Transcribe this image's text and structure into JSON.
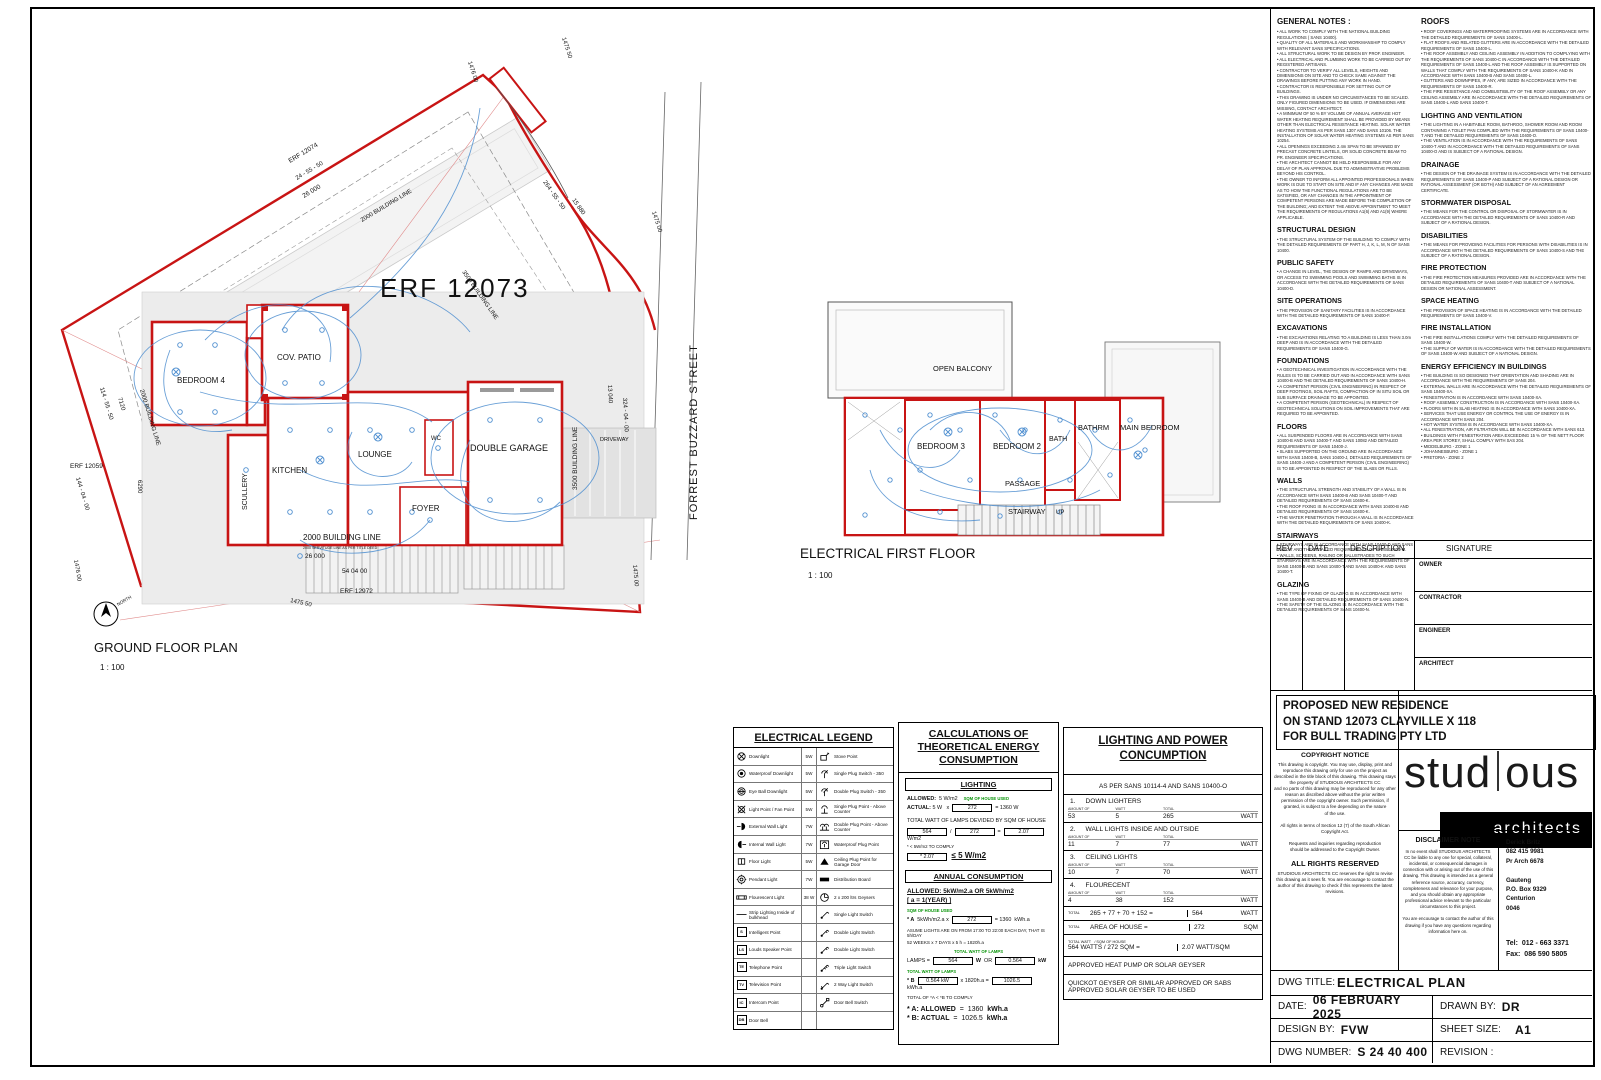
{
  "ground": {
    "plan_title": "GROUND FLOOR PLAN",
    "scale": "1 : 100",
    "erf": "ERF 12073",
    "north": "NORTH",
    "rooms": {
      "bedroom4": "BEDROOM 4",
      "patio": "COV. PATIO",
      "kitchen": "KITCHEN",
      "scullery": "SCULLERY",
      "lounge": "LOUNGE",
      "wc": "WC",
      "foyer": "FOYER",
      "garage": "DOUBLE GARAGE",
      "driveway": "DRIVEWAY"
    },
    "labels": {
      "erf12074": "ERF 12074",
      "erf12059": "ERF 12059",
      "erf12972": "ERF 12972",
      "street": "FORREST BUZZARD STREET",
      "bl2000_top": "2000 BUILDING LINE",
      "bl3500_top": "3500 BUILDING LINE",
      "bl2000_left": "2000 BUILDING LINE",
      "bl2000_bottom": "2000 BUILDING LINE",
      "bl3500_right": "3500 BUILDING LINE",
      "servitude": "2000 SERVITUDE LINE AS PER TITLE DEED",
      "d_1476_top": "1476 00",
      "d_1475_50_top": "1475 50",
      "d_24_55_50": "24 - 55 - 50",
      "d_26000_top": "26 000",
      "d_264_55_50": "264 - 55 - 50",
      "d_15880": "15 880",
      "d_1475_00_right": "1475 00",
      "d_114_55_50": "114 - 55 - 50",
      "d_7120": "7120",
      "d_6290": "6290",
      "d_144_04_00": "144 - 04 - 00",
      "d_13040": "13 040",
      "d_324_04_00": "324 - 04 - 00",
      "d_26000_bottom": "26 000",
      "d_54_04_00": "54 04 00",
      "d_1475_50_bottom": "1475 50",
      "d_1476_bottom": "1476 00",
      "d_1475_00_bottom": "1475 00"
    }
  },
  "first": {
    "plan_title": "ELECTRICAL FIRST FLOOR",
    "scale": "1 : 100",
    "rooms": {
      "balcony": "OPEN BALCONY",
      "bedroom3": "BEDROOM 3",
      "bedroom2": "BEDROOM 2",
      "bath": "BATH",
      "bathrm": "BATHRM",
      "main_bedroom": "MAIN BEDROOM",
      "passage": "PASSAGE",
      "stairway": "STAIRWAY",
      "up": "UP"
    }
  },
  "notes_col1": [
    {
      "heading": "GENERAL NOTES :",
      "body": "• ALL WORK TO COMPLY WITH THE NATIONAL BUILDING REGULATIONS ( SANS 10400).\n• QUALITY OF ALL MATERIALS AND WORKMANSHIP TO COMPLY WITH RELEVANT SANS SPECIFICATIONS.\n• ALL STRUCTURAL WORK TO BE DESIGN BY PROF. ENGINEER.\n• ALL ELECTRICAL AND PLUMBING WORK TO BE CARRIED OUT BY REGISTERED ARTISANS.\n• CONTRACTOR TO VERIFY ALL LEVELS, HEIGHTS AND DIMENSIONS ON SITE AND TO CHECK SAME AGAINST THE DRAWINGS BEFORE PUTTING ANY WORK IN HAND.\n• CONTRACTOR IS RESPONSIBLE FOR SETTING OUT OF BUILDINGS.\n• THIS DRAWING IS UNDER NO CIRCUMSTANCES TO BE SCALED.  ONLY FIGURED DIMENSIONS TO BE USED.  IF DIMENSIONS ARE MISSING, CONTACT ARCHITECT.\n• A MINIMUM OF 50 % BY VOLUME OF ANNUAL AVERAGE HOT WATER HEATING REQUIREMENT SHALL BE PROVIDED BY MEANS OTHER THAN ELECTRICAL RESISTANCE HEATING. SOLAR WATER HEATING SYSTEMS AS PER SANS 1307 AND SANS 10106.  THE INSTALLATION OF SOLAR WATER HEATING SYSTEMS AS PER SANS 10254.\n• ALL OPENINGS EXCEEDING 2.4m SPAN TO BE SPANNED BY PRECAST CONCRETE LINTELS, OR SOLID CONCRETE BEAM TO PR. ENGINEER SPECIFICATIONS.\n• THE ARCHITECT CANNOT BE HELD RESPONSIBLE FOR ANY DELAY OF PLAN APPROVAL DUE TO ADMINISTRATIVE PROBLEMS BEYOND HIS CONTROL.\n• THE OWNER TO INFORM ALL APPOINTED PROFESSIONALS WHEN WORK IS DUE TO START ON SITE AND IF ANY CHANGES ARE MADE AS TO HOW THE FUNCTIONAL REGULATIONS ARE TO BE SATISFIED, OR ANY CHANGES IN THE APPOINTMENT OF COMPETENT PERSONS ARE MADE BEFORE THE COMPLETION OF THE BUILDING;  AND EXTENT THE ABOVE APPOINTMENT TO MEET THE REQUIREMENTS OF REGULATIONS A1(6) AND A1(9) WHERE APPLICABLE."
    },
    {
      "heading": "STRUCTURAL DESIGN",
      "body": "• THE STRUCTURAL SYSTEM OF THE BUILDING TO COMPLY WITH THE DETAILED REQUIREMENTS OF PART H, J, K, L, M, N OF SANS 10400."
    },
    {
      "heading": "PUBLIC SAFETY",
      "body": "• A CHANGE IN LEVEL, THE DESIGN OF RAMPS AND DRIVEWAYS, OR ACCESS TO SWIMMING POOLS AND SWIMMING BATHS IS IN ACCORDANCE WITH THE DETAILED REQUIREMENTS OF SANS 10400-D."
    },
    {
      "heading": "SITE OPERATIONS",
      "body": "• THE PROVISION OF SANITARY FACILITIES IS IN ACCORDANCE WITH THE DETAILED REQUIREMENTS OF SANS 10400-F."
    },
    {
      "heading": "EXCAVATIONS",
      "body": "• THE EXCAVATIONS RELATING TO A BUILDING IS LESS THAN 3.0m DEEP AND IS IN ACCORDANCE WITH THE DETAILED REQUIREMENTS OF SANS 10400-G."
    },
    {
      "heading": "FOUNDATIONS",
      "body": "• A GEOTECHNICAL INVESTIGATION IN ACCORDANCE WITH THE RULES IS TO BE CARRIED OUT AND IN ACCORDANCE WITH SANS 10400-B AND THE DETAILED REQUIREMENTS OF SANS 10400-H.\n• A COMPETENT PERSON (CIVIL ENGINEERING) IN RESPECT OF DEEP FOOTINGS, SOIL RAFTS, COMPACTION OF IN SITU SOIL OR SUB SURFACE DRAINAGE TO BE APPOINTED.\n• A COMPETENT PERSON (GEOTECHNICAL) IN RESPECT OF GEOTECHNICAL SOLUTIONS ON SOIL IMPROVEMENTS THAT ARE REQUIRED TO BE APPOINTED."
    },
    {
      "heading": "FLOORS",
      "body": "• ALL SUSPENDED FLOORS ARE IN ACCORDANCE WITH SANS 10400-B AND SANS 10400-T AND SANS 10082 AND DETAILED REQUIREMENTS OF SANS 10400-J.\n• SLABS SUPPORTED ON THE GROUND ARE IN ACCORDANCE WITH SANS 10400-B, SANS 10400-J, DETAILED REQUIREMENTS OF SANS 10400-J AND A COMPETENT PERSON (CIVIL ENGINEERING) IS TO BE APPOINTED IN RESPECT OF THE SLABS OR FILLS."
    },
    {
      "heading": "WALLS",
      "body": "• THE STRUCTURAL STRENGTH AND STABILITY OF A WALL IS IN ACCORDANCE WITH SANS 10400-B AND SANS 10400-T AND DETAILED REQUIREMENTS OF SANS 10400-K.\n• THE ROOF FIXING IS IN ACCORDANCE WITH SANS 10400-B AND DETAILED REQUIREMENTS OF SANS 10400-K.\n• THE WATER PENETRATION THROUGH A WALL IS IN ACCORDANCE WITH THE DETAILED REQUIREMENTS OF SANS 10400-K."
    },
    {
      "heading": "STAIRWAYS",
      "body": "• STAIRWAYS ARE IN ACCORDANCE WITH SANS 10400-D AND SANS 10400-T AND THE DETAILED REQUIREMENTS OF SANS 10400-M.\n• WALLS, SCREENS, RAILING OR BALUSTRADES TO SUCH STAIRWAYS ARE IN ACCORDANCE WITH THE REQUIREMENTS OF SANS 10400-B AND SANS 10400-T AND SANS 10400-K AND SANS 10400-T."
    },
    {
      "heading": "GLAZING",
      "body": "• THE TYPE OF FIXING OF GLAZING IS IN ACCORDANCE WITH SANS 10400-B AND DETAILED REQUIREMENTS OF SANS 10400-N.\n• THE SAFETY OF THE GLAZING IS IN ACCORDANCE WITH THE DETAILED REQUIREMENTS OF SANS 10400-N."
    }
  ],
  "notes_col2": [
    {
      "heading": "ROOFS",
      "body": "• ROOF COVERINGS AND WATERPROOFING SYSTEMS ARE IN ACCORDANCE WITH THE DETAILED REQUIREMENTS OF SANS 10400-L.\n• FLAT ROOFS AND RELATED GUTTERS ARE IN ACCORDANCE WITH THE DETAILED REQUIREMENTS OF SANS 10400-L.\n• THE ROOF ASSEMBLY AND CEILING ASSEMBLY IN ADDITION TO COMPLYING WITH THE REQUIREMENTS OF SANS 10400-C IN ACCORDANCE WITH THE DETAILED REQUIREMENTS OF SANS 10400-L AND THE ROOF ASSEMBLY IS SUPPORTED ON WALLS THAT COMPLY WITH THE REQUIREMENTS OF SANS 10400-K AND IN ACCORDANCE WITH SANS 10400-B AND SANS 10400-L.\n• GUTTERS AND DOWNPIPES, IF ANY, ARE SIZED IN ACCORDANCE WITH THE REQUIREMENTS OF SANS 10400-R.\n• THE FIRE RESISTANCE AND COMBUSTIBILITY OF THE ROOF ASSEMBLY OR ANY CEILING ASSEMBLY ARE IN ACCORDANCE WITH THE DETAILED REQUIREMENTS OF SANS 10400-L AND SANS 10400-T."
    },
    {
      "heading": "LIGHTING AND VENTILATION",
      "body": "• THE LIGHTING IN A HABITABLE ROOM, BATHROO, SHOWER ROOM AND ROOM CONTAINING A TOILET PAN COMPLIED WITH THE REQUIREMENTS OF SANS 10400-T AND THE DETAILED REQUIREMENTS OF SANS 10400-O.\n• THE VENTILATION IS IN ACCORDANCE WITH THE REQUIREMENTS OF SANS 10400-T AND IN ACCORDANCE WITH THE DETAILED REQUIREMENTS OF SANS 10400-O AND IS SUBJECT OF A RATIONAL DESIGN."
    },
    {
      "heading": "DRAINAGE",
      "body": "• THE DESIGN OF THE DRAINAGE SYSTEM IS IN ACCORDANCE WITH THE DETAILED REQUIREMENTS OF SANS 10400-P AND SUBJECT OF A RATIONAL DESIGN OR RATIONAL ASSESSMENT (OR BOTH) AND SUBJECT OF AN AGREEMENT CERTIFICATE."
    },
    {
      "heading": "STORMWATER DISPOSAL",
      "body": "• THE MEANS FOR THE CONTROL OR DISPOSAL OF STORMWATER IS IN ACCORDANCE WITH THE DETAILED REQUIREMENTS OF SANS 10400-R AND SUBJECT OF A RATIONAL DESIGN."
    },
    {
      "heading": "DISABILITIES",
      "body": "• THE MEANS FOR PROVIDING FACILITIES FOR PERSONS WITH DISABILITIES IS IN ACCORDANCE WITH THE DETAILED REQUIREMENTS OF SANS 10400-S AND THE SUBJECT OF A RATIONAL DESIGN."
    },
    {
      "heading": "FIRE PROTECTION",
      "body": "• THE FIRE PROTECTION MEASURES PROVIDED ARE IN ACCORDANCE WITH THE DETAILED REQUIREMENTS OF SANS 10400-T AND SUBJECT OF A NATIONAL DESIGN OR NATIONAL ASSESSMENT."
    },
    {
      "heading": "SPACE HEATING",
      "body": "• THE PROVISION OF SPACE HEATING IS IN ACCORDANCE WITH THE DETAILED REQUIREMENTS OF SANS 10400-V."
    },
    {
      "heading": "FIRE INSTALLATION",
      "body": "• THE FIRE INSTALLATIONS COMPLY WITH THE DETAILED REQUIREMENTS OF SANS 10400-W.\n• THE SUPPLY OF WATER IS IN ACCORDANCE WITH THE DETAILED REQUIREMENTS OF SANS 10400-W AND SUBJECT OF A NATIONAL DESIGN."
    },
    {
      "heading": "ENERGY EFFICIENCY IN  BUILDINGS",
      "body": "• THE BUILDING IS SO DESIGNED THAT ORIENTATION AND SHADING ARE IN ACCORDANCE WITH THE REQUIREMENTS OF SANS 204.\n• EXTERNAL WALLS ARE IN ACCORDANCE WITH THE DETAILED REQUIREMENTS OF SANS 10400-XA.\n• FENESTRATION IS IN ACCORDANCE WITH SANS 10400-XA.\n• ROOF ASSEMBLY CONSTRUCTION IS IN ACCORDANCE WITH SANS 10400-XA.\n• FLOORS WITH IN SLAB HEATING IS IN ACCORDANCE WITH SANS 10400-XA.\n• SERVICES THAT USE ENERGY OR CONTROL THE USE OF ENERGY IS IN ACCORDANCE WITH SANS 204.\n• HOT WATER SYSTEM IS IN ACCORDANCE WITH SANS 10400-XA.\n• ALL FENESTRATION, AIR FILTRATION WILL BE IN ACCORDANCE WITH SANS 613.\n• BUILDINGS WITH FENESTRATION AREA EXCEEDING 15 % OF THE NETT FLOOR AREA PER STOREY, SHALL COMPLY WITH SAS 204.\n• MIDDELBURG - ZONE 1\n• JOHANNESBURG - ZONE 1\n• PRETORIA - ZONE 2"
    }
  ],
  "rev": {
    "rev": "REV",
    "date": "DATE",
    "description": "DESCRIPTION",
    "signature": "SIGNATURE",
    "roles": [
      "OWNER",
      "CONTRACTOR",
      "ENGINEER",
      "ARCHITECT"
    ]
  },
  "project": {
    "line1": "PROPOSED NEW RESIDENCE",
    "line2": "ON STAND 12073 CLAYVILLE X 118",
    "line3": "FOR BULL TRADING PTY LTD"
  },
  "copyright": {
    "title": "COPYRIGHT NOTICE",
    "body": "This drawing is copyright.  You may use, display, print and reproduce this drawing only for use on the project as described in the title block of this drawing.  This drawing stays the property of STUDIOUS ARCHITECTS CC\nand no parts of this drawing may be reproduced for any other reason as discribed above without the prior written permission of the copyright owner.  Such permission, if granted, is subject to a fee depending on the nature\nof the use.",
    "rights": "All rights in terms of Section 12 (7) of the South African Copyright Act.",
    "requests": "Requests and inquiries regarding reproduction\nshould be addressed to the Copyright Owner.",
    "reserved_title": "ALL RIGHTS RESERVED",
    "reserved_body": "STUDIOUS ARCHITECTS CC reserves the right to revise this drawing as it sees fit. You are encourage to contact the author of this drawing to check if this represents the latest revisions."
  },
  "brand": {
    "name_a": "stud",
    "name_b": "ous",
    "sub": "architects"
  },
  "disclaimer": {
    "title": "DISCLAIMER NOTE",
    "body": "In no event shall STUDIOUS ARCHITECTS CC be liable to any one for special, collateral, incidental, or consequencial damages in connection with or arising out of the use of this drawing.  This drawing is intended as a general reference source, accuracy, currency, completeness and relevance for your purpose, and you should obtain any appropriate professional advice relevant to the particular circumstances to this project.",
    "footer": "You are encourage to contact the author of this drawing if you have any questions regarding information here on."
  },
  "contact": {
    "name": "Derick Britz",
    "phone": "082 415 9981",
    "reg": "Pr Arch 6678",
    "province": "Gauteng",
    "pobox": "P.O. Box 9329",
    "city": "Centurion",
    "postal": "0046",
    "tel_label": "Tel:",
    "tel": "012 - 663 3371",
    "fax_label": "Fax:",
    "fax": "086 590 5805"
  },
  "titleblock": {
    "dwg_title_label": "DWG TITLE:",
    "dwg_title": "ELECTRICAL PLAN",
    "date_label": "DATE:",
    "date": "06 FEBRUARY 2025",
    "drawn_label": "DRAWN BY:",
    "drawn": "DR",
    "design_label": "DESIGN BY:",
    "design": "FVW",
    "sheet_label": "SHEET SIZE:",
    "sheet": "A1",
    "number_label": "DWG NUMBER:",
    "number": "S 24 40 400",
    "revision_label": "REVISION :"
  },
  "legend": {
    "title": "ELECTRICAL LEGEND",
    "left": [
      {
        "label": "Downlight",
        "watt": "5W"
      },
      {
        "label": "Waterproof Downlight",
        "watt": "5W"
      },
      {
        "label": "Eye Ball Downlight",
        "watt": "5W"
      },
      {
        "label": "Light Point / Fan Point",
        "watt": "5W"
      },
      {
        "label": "External Wall Light",
        "watt": "7W"
      },
      {
        "label": "Internal Wall Light",
        "watt": "7W"
      },
      {
        "label": "Floor Light",
        "watt": "5W"
      },
      {
        "label": "Pendant Light",
        "watt": "7W"
      },
      {
        "label": "Flourescent Light",
        "watt": "38 W"
      },
      {
        "label": "Strip Lighting Inside of bulkhead",
        "watt": ""
      },
      {
        "label": "Intelligent Point",
        "watt": ""
      },
      {
        "label": "Louds Speaker Point",
        "watt": ""
      },
      {
        "label": "Telephone Point",
        "watt": ""
      },
      {
        "label": "Television Point",
        "watt": ""
      },
      {
        "label": "Intercom Point",
        "watt": ""
      },
      {
        "label": "Door Bell",
        "watt": ""
      }
    ],
    "right": [
      {
        "label": "Stove Point"
      },
      {
        "label": "Single Plug Switch - 350"
      },
      {
        "label": "Double Plug Switch - 350"
      },
      {
        "label": "Single Plug Point - Above Counter"
      },
      {
        "label": "Double Plug Point - Above Counter"
      },
      {
        "label": "Waterproof Plug Point"
      },
      {
        "label": "Ceiling Plug Point for Garage Door"
      },
      {
        "label": "Distribution Board"
      },
      {
        "label": "2 x 200 ltrs Geysers"
      },
      {
        "label": "Single Light Switch"
      },
      {
        "label": "Double Light Switch"
      },
      {
        "label": "Double Light Switch"
      },
      {
        "label": "Triple Light Switch"
      },
      {
        "label": "2 Way Light Switch"
      },
      {
        "label": "Door Bell Switch"
      },
      {
        "label": ""
      }
    ]
  },
  "calc": {
    "title": "CALCULATIONS OF THEORETICAL ENERGY CONSUMPTION",
    "lighting_h": "LIGHTING",
    "allowed_label": "ALLOWED:",
    "allowed_val": "5 W/m2",
    "sqm_used": "SQM OF HOUSE USED",
    "actual_label": "ACTUAL:",
    "actual_watt": "5 W",
    "x": "x",
    "sqm": "272",
    "eq1_result": "= 1360  W",
    "lamps_divided": "TOTAL WATT OF LAMPS   DEVIDED BY SQM OF HOUSE",
    "total_watt": "564",
    "div": "/",
    "house_sqm": "272",
    "eq": "=",
    "wpm2": "2.07",
    "wpm2_unit": "W/m2",
    "comply_note": "* < 5W/m2 TO COMPLY",
    "comply_val": "*  2.07",
    "comply_limit": "≤  5 W/m2",
    "annual_h": "ANNUAL CONSUMPTION",
    "annual_allowed": "ALLOWED:  5kW/m2.a  OR  5kWh/m2",
    "annual_year": "[ a = 1(YEAR) ]",
    "a_label": "* A",
    "a_rate": "5kWh/m2.a",
    "a_x": "x",
    "a_sqm": "272",
    "a_eq": "=",
    "a_total": "1360",
    "a_unit": "kWh.a",
    "sqm_used2": "SQM OF HOUSE USED",
    "assume": "ASUME LIGHTS ARE ON FROM 17:00 TO 22:00 EACH DAY, THAT IS 5h/DAY",
    "weeks": "52 WEEKS x 7 DAYS x 5 h = 1820h.a",
    "total_watt_lamps": "TOTAL WATT OF LAMPS",
    "lamps_label": "LAMPS =",
    "lamps_w": "564",
    "w_unit": "W",
    "or": "OR",
    "lamps_kw": "0.564",
    "kw_unit": "kW",
    "b_label": "* B",
    "b_kw": "0.564   kW",
    "b_x": "x 1820h.a =",
    "b_total": "1026.5",
    "b_unit": "kWh.a",
    "total_comply": "TOTAL OF *A < *B   TO COMPLY",
    "a_allowed_label": "* A: ALLOWED",
    "a_allowed_eq": "=",
    "a_allowed_val": "1360",
    "a_allowed_unit": "kWh.a",
    "b_actual_label": "* B: ACTUAL",
    "b_actual_eq": "=",
    "b_actual_val": "1026.5",
    "b_actual_unit": "kWh.a"
  },
  "power": {
    "title": "LIGHTING AND POWER CONCUMPTION",
    "subtitle": "AS PER SANS 10114-4 AND SANS 10400-O",
    "col_amount": "AMOUNT OF",
    "col_watt": "WATT",
    "col_total": "TOTAL",
    "unit": "WATT",
    "items": [
      {
        "no": "1.",
        "name": "DOWN LIGHTERS",
        "amount": "53",
        "watt": "5",
        "total": "265",
        "unit": "WATT"
      },
      {
        "no": "2.",
        "name": "WALL LIGHTS INSIDE AND OUTSIDE",
        "amount": "11",
        "watt": "7",
        "total": "77",
        "unit": "WATT"
      },
      {
        "no": "3.",
        "name": "CEILING LIGHTS",
        "amount": "10",
        "watt": "7",
        "total": "70",
        "unit": "WATT"
      },
      {
        "no": "4.",
        "name": "FLOURECENT",
        "amount": "4",
        "watt": "38",
        "total": "152",
        "unit": "WATT"
      }
    ],
    "total_label": "TOTAL",
    "total_eq": "265 + 77 + 70 + 152 =",
    "total_val": "564",
    "total_unit": "WATT",
    "area_label": "AREA OF HOUSE =",
    "area_val": "272",
    "area_unit": "SQM",
    "tw_label": "TOTAL WATT",
    "tw_label2": "/ SQM OF HOUSE",
    "persqm_eq": "564 WATTS / 272 SQM =",
    "persqm_val": "2.07 WATT/SQM",
    "heat": "APPROVED HEAT PUMP OR SOLAR GEYSER",
    "geyser": "QUICKOT GEYSER OR SIMILAR APPROVED OR SABS APPROVED SOLAR GEYSER TO BE USED"
  }
}
